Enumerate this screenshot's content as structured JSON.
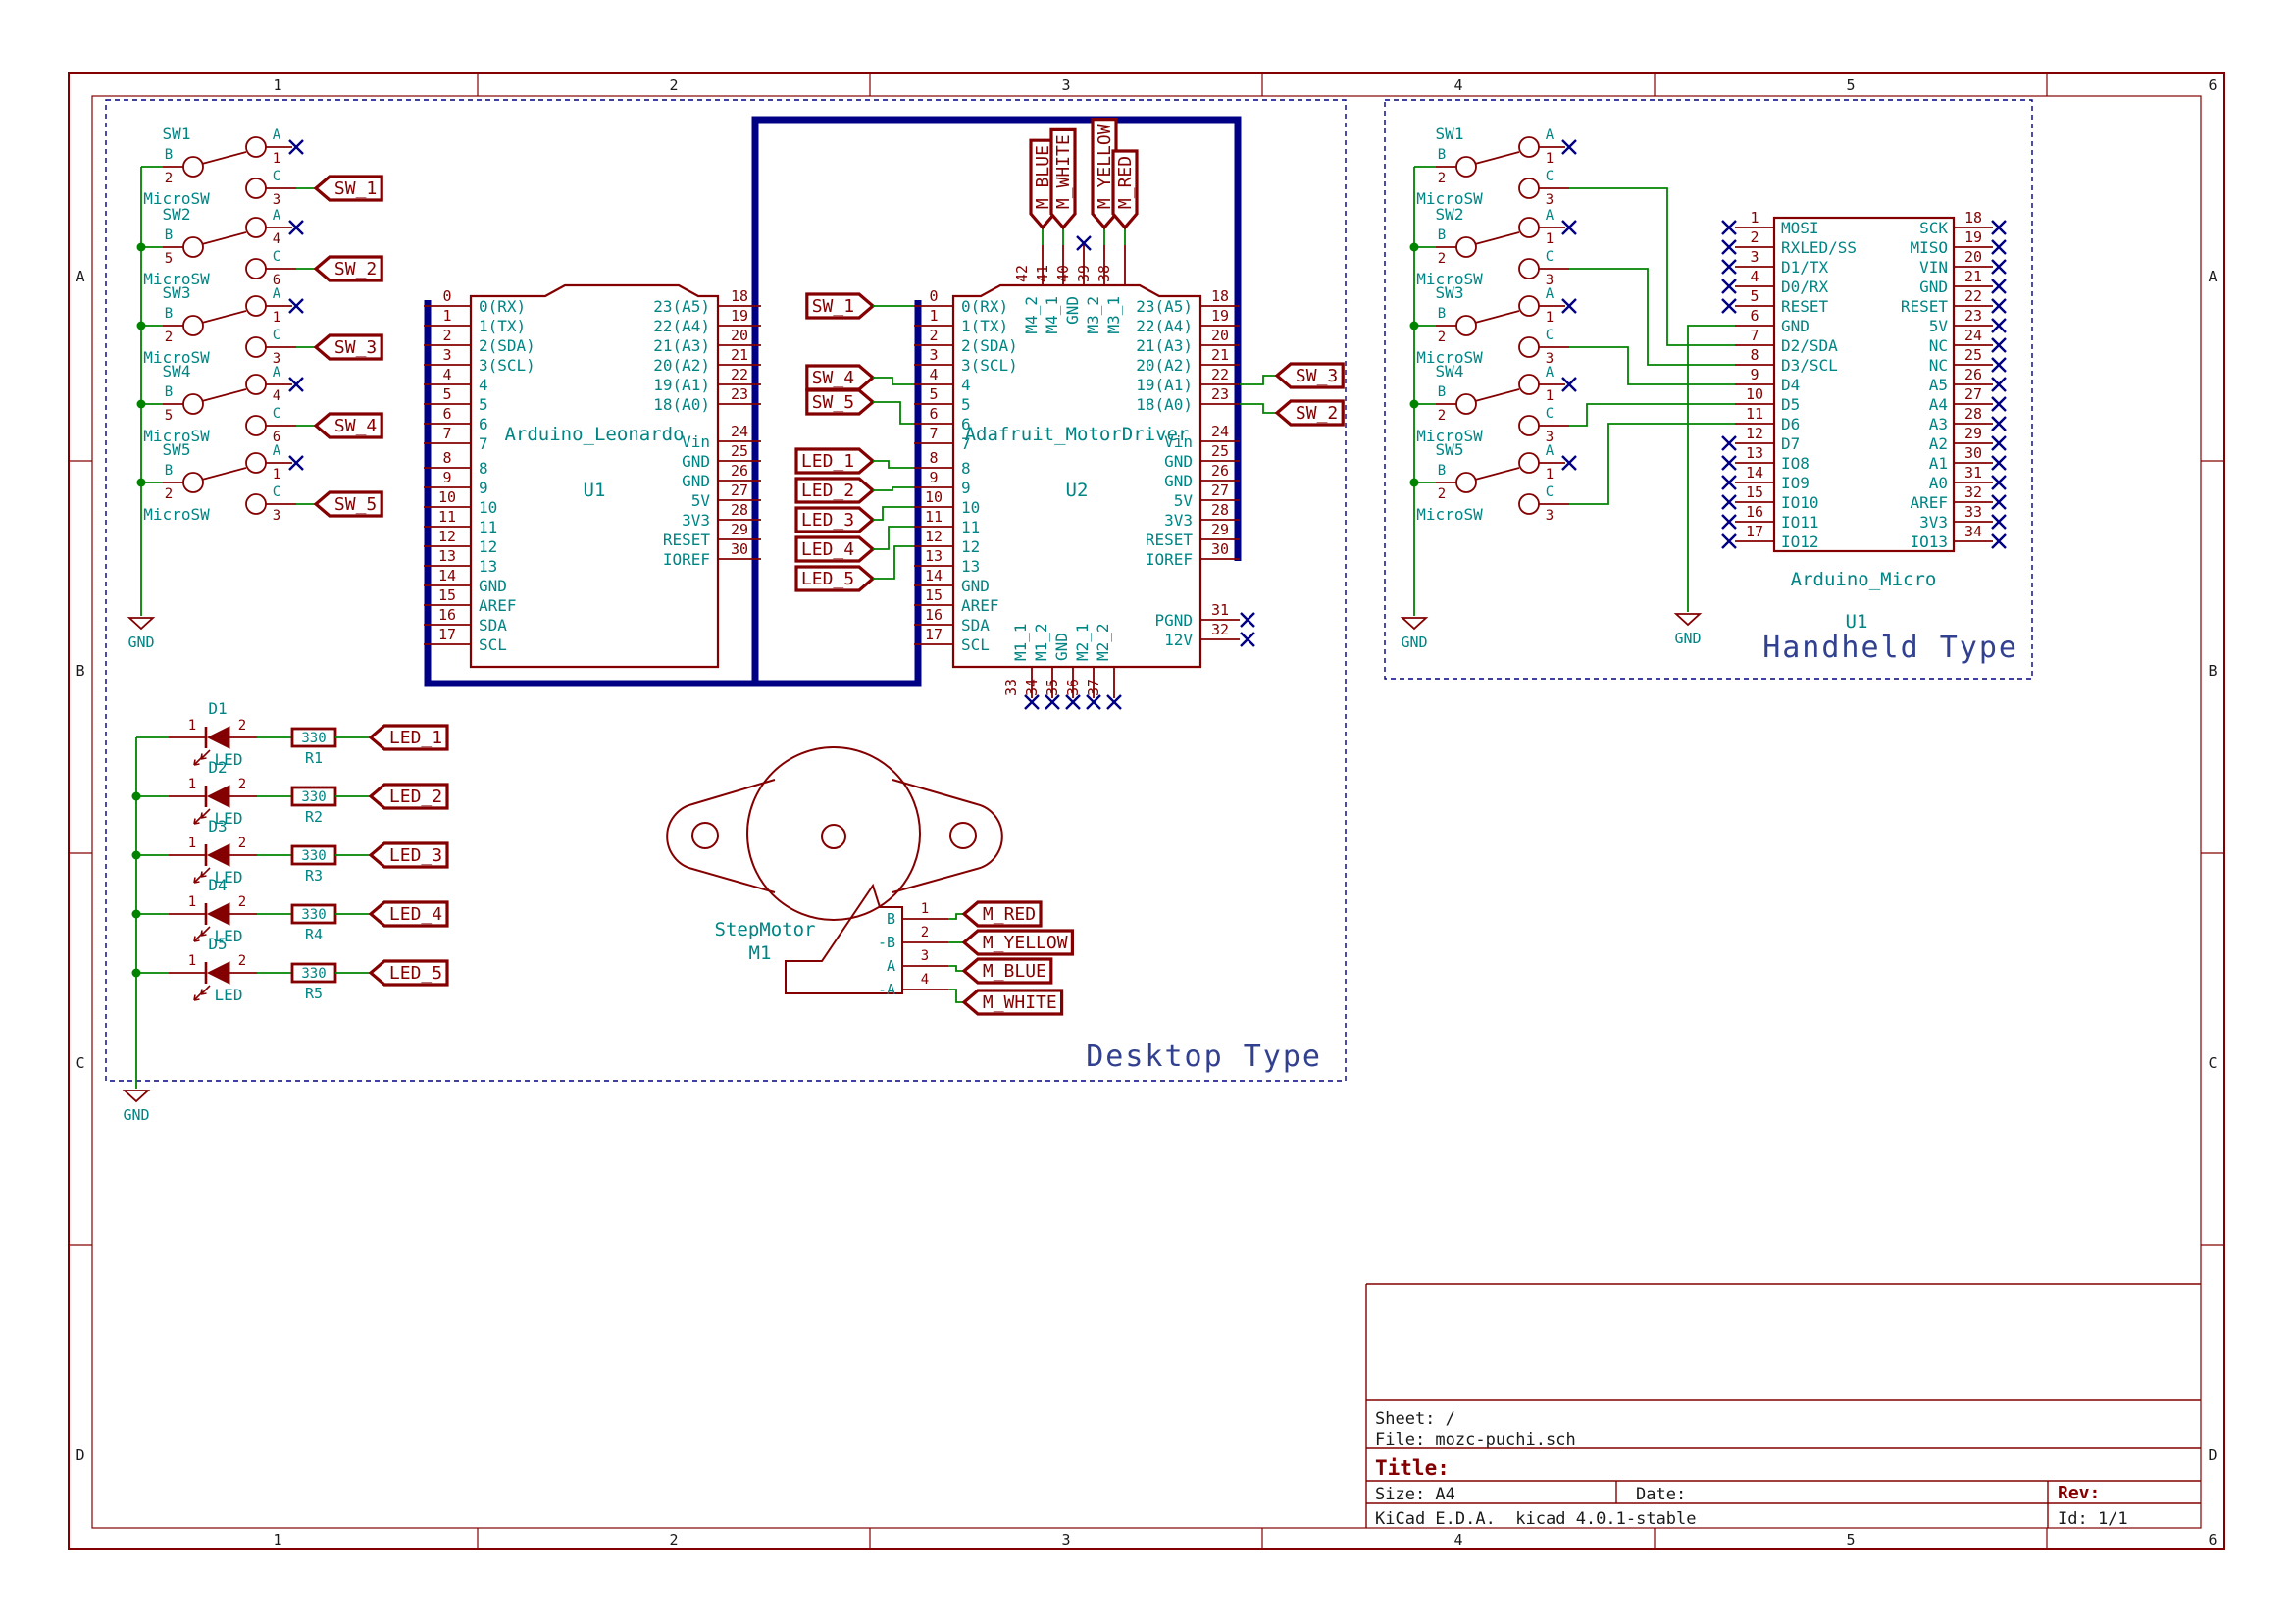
{
  "colors": {
    "component": "#840000",
    "pin_name": "#008484",
    "wire": "#008400",
    "bus": "#000084",
    "noconnect": "#000084",
    "notes": "#31418f",
    "border": "#840000",
    "black": "#1a1a1a"
  },
  "sheet": {
    "cols": [
      "1",
      "2",
      "3",
      "4",
      "5",
      "6"
    ],
    "rows": [
      "A",
      "B",
      "C",
      "D"
    ],
    "title_block": {
      "sheet": "Sheet: /",
      "file": "File: mozc-puchi.sch",
      "title_label": "Title:",
      "size": "Size: A4",
      "date": "Date:",
      "rev_label": "Rev:",
      "kicad": "KiCad E.D.A.  kicad 4.0.1-stable",
      "id": "Id: 1/1"
    }
  },
  "sections": {
    "desktop": "Desktop Type",
    "handheld": "Handheld Type"
  },
  "gnd": "GND",
  "pin_letters": [
    "A",
    "B",
    "C"
  ],
  "switch_value": "MicroSW",
  "ics": {
    "leonardo": {
      "ref": "U1",
      "value": "Arduino_Leonardo",
      "left_nums": [
        "0",
        "1",
        "2",
        "3",
        "4",
        "5",
        "6",
        "7",
        "8",
        "9",
        "10",
        "11",
        "12",
        "13",
        "14",
        "15",
        "16",
        "17"
      ],
      "left_names": [
        "0(RX)",
        "1(TX)",
        "2(SDA)",
        "3(SCL)",
        "4",
        "5",
        "6",
        "7",
        "8",
        "9",
        "10",
        "11",
        "12",
        "13",
        "GND",
        "AREF",
        "SDA",
        "SCL"
      ],
      "right_nums": [
        "18",
        "19",
        "20",
        "21",
        "22",
        "23",
        "24",
        "25",
        "26",
        "27",
        "28",
        "29",
        "30"
      ],
      "right_names": [
        "23(A5)",
        "22(A4)",
        "21(A3)",
        "20(A2)",
        "19(A1)",
        "18(A0)",
        "Vin",
        "GND",
        "GND",
        "5V",
        "3V3",
        "RESET",
        "IOREF"
      ]
    },
    "motordriver": {
      "ref": "U2",
      "value": "Adafruit_MotorDriver",
      "left_nums": [
        "0",
        "1",
        "2",
        "3",
        "4",
        "5",
        "6",
        "7",
        "8",
        "9",
        "10",
        "11",
        "12",
        "13",
        "14",
        "15",
        "16",
        "17"
      ],
      "left_names": [
        "0(RX)",
        "1(TX)",
        "2(SDA)",
        "3(SCL)",
        "4",
        "5",
        "6",
        "7",
        "8",
        "9",
        "10",
        "11",
        "12",
        "13",
        "GND",
        "AREF",
        "SDA",
        "SCL"
      ],
      "right_nums": [
        "18",
        "19",
        "20",
        "21",
        "22",
        "23",
        "24",
        "25",
        "26",
        "27",
        "28",
        "29",
        "30"
      ],
      "right_names": [
        "23(A5)",
        "22(A4)",
        "21(A3)",
        "20(A2)",
        "19(A1)",
        "18(A0)",
        "Vin",
        "GND",
        "GND",
        "5V",
        "3V3",
        "RESET",
        "IOREF"
      ],
      "extra_right_nums": [
        "31",
        "32"
      ],
      "extra_right_names": [
        "PGND",
        "12V"
      ],
      "top_nums": [
        "42",
        "41",
        "40",
        "39",
        "38"
      ],
      "top_names": [
        "M4_2",
        "M4_1",
        "GND",
        "M3_2",
        "M3_1"
      ],
      "bottom_nums": [
        "33",
        "34",
        "35",
        "36",
        "37"
      ],
      "bottom_names": [
        "M1_1",
        "M1_2",
        "GND",
        "M2_1",
        "M2_2"
      ]
    },
    "micro": {
      "ref": "U1",
      "value": "Arduino_Micro",
      "left_nums": [
        "1",
        "2",
        "3",
        "4",
        "5",
        "6",
        "7",
        "8",
        "9",
        "10",
        "11",
        "12",
        "13",
        "14",
        "15",
        "16",
        "17"
      ],
      "left_names": [
        "MOSI",
        "RXLED/SS",
        "D1/TX",
        "D0/RX",
        "RESET",
        "GND",
        "D2/SDA",
        "D3/SCL",
        "D4",
        "D5",
        "D6",
        "D7",
        "IO8",
        "IO9",
        "IO10",
        "IO11",
        "IO12"
      ],
      "right_nums": [
        "18",
        "19",
        "20",
        "21",
        "22",
        "23",
        "24",
        "25",
        "26",
        "27",
        "28",
        "29",
        "30",
        "31",
        "32",
        "33",
        "34"
      ],
      "right_names": [
        "SCK",
        "MISO",
        "VIN",
        "GND",
        "RESET",
        "5V",
        "NC",
        "NC",
        "A5",
        "A4",
        "A3",
        "A2",
        "A1",
        "A0",
        "AREF",
        "3V3",
        "IO13"
      ]
    }
  },
  "desktop_switches": [
    {
      "ref": "SW1",
      "pin_a": "1",
      "pin_b": "2",
      "pin_c": "3",
      "tag": "SW_1"
    },
    {
      "ref": "SW2",
      "pin_a": "4",
      "pin_b": "5",
      "pin_c": "6",
      "tag": "SW_2"
    },
    {
      "ref": "SW3",
      "pin_a": "1",
      "pin_b": "2",
      "pin_c": "3",
      "tag": "SW_3"
    },
    {
      "ref": "SW4",
      "pin_a": "4",
      "pin_b": "5",
      "pin_c": "6",
      "tag": "SW_4"
    },
    {
      "ref": "SW5",
      "pin_a": "1",
      "pin_b": "2",
      "pin_c": "3",
      "tag": "SW_5"
    }
  ],
  "handheld_switches": [
    {
      "ref": "SW1",
      "pin_a": "1",
      "pin_b": "2",
      "pin_c": "3"
    },
    {
      "ref": "SW2",
      "pin_a": "1",
      "pin_b": "2",
      "pin_c": "3"
    },
    {
      "ref": "SW3",
      "pin_a": "1",
      "pin_b": "2",
      "pin_c": "3"
    },
    {
      "ref": "SW4",
      "pin_a": "1",
      "pin_b": "2",
      "pin_c": "3"
    },
    {
      "ref": "SW5",
      "pin_a": "1",
      "pin_b": "2",
      "pin_c": "3"
    }
  ],
  "leds": [
    {
      "ref": "D1",
      "value": "LED",
      "pin1": "1",
      "pin2": "2",
      "res_ref": "R1",
      "res_value": "330",
      "tag": "LED_1"
    },
    {
      "ref": "D2",
      "value": "LED",
      "pin1": "1",
      "pin2": "2",
      "res_ref": "R2",
      "res_value": "330",
      "tag": "LED_2"
    },
    {
      "ref": "D3",
      "value": "LED",
      "pin1": "1",
      "pin2": "2",
      "res_ref": "R3",
      "res_value": "330",
      "tag": "LED_3"
    },
    {
      "ref": "D4",
      "value": "LED",
      "pin1": "1",
      "pin2": "2",
      "res_ref": "R4",
      "res_value": "330",
      "tag": "LED_4"
    },
    {
      "ref": "D5",
      "value": "LED",
      "pin1": "1",
      "pin2": "2",
      "res_ref": "R5",
      "res_value": "330",
      "tag": "LED_5"
    }
  ],
  "motor": {
    "ref": "M1",
    "value": "StepMotor",
    "pins": [
      {
        "num": "1",
        "name": "B",
        "tag": "M_RED"
      },
      {
        "num": "2",
        "name": "-B",
        "tag": "M_YELLOW"
      },
      {
        "num": "3",
        "name": "A",
        "tag": "M_BLUE"
      },
      {
        "num": "4",
        "name": "-A",
        "tag": "M_WHITE"
      }
    ]
  },
  "u2_left_tags": [
    "SW_1",
    "SW_4",
    "SW_5",
    "LED_1",
    "LED_2",
    "LED_3",
    "LED_4",
    "LED_5"
  ],
  "u2_right_tags": [
    "SW_3",
    "SW_2"
  ],
  "u2_top_tags": [
    "M_BLUE",
    "M_WHITE",
    "M_YELLOW",
    "M_RED"
  ]
}
